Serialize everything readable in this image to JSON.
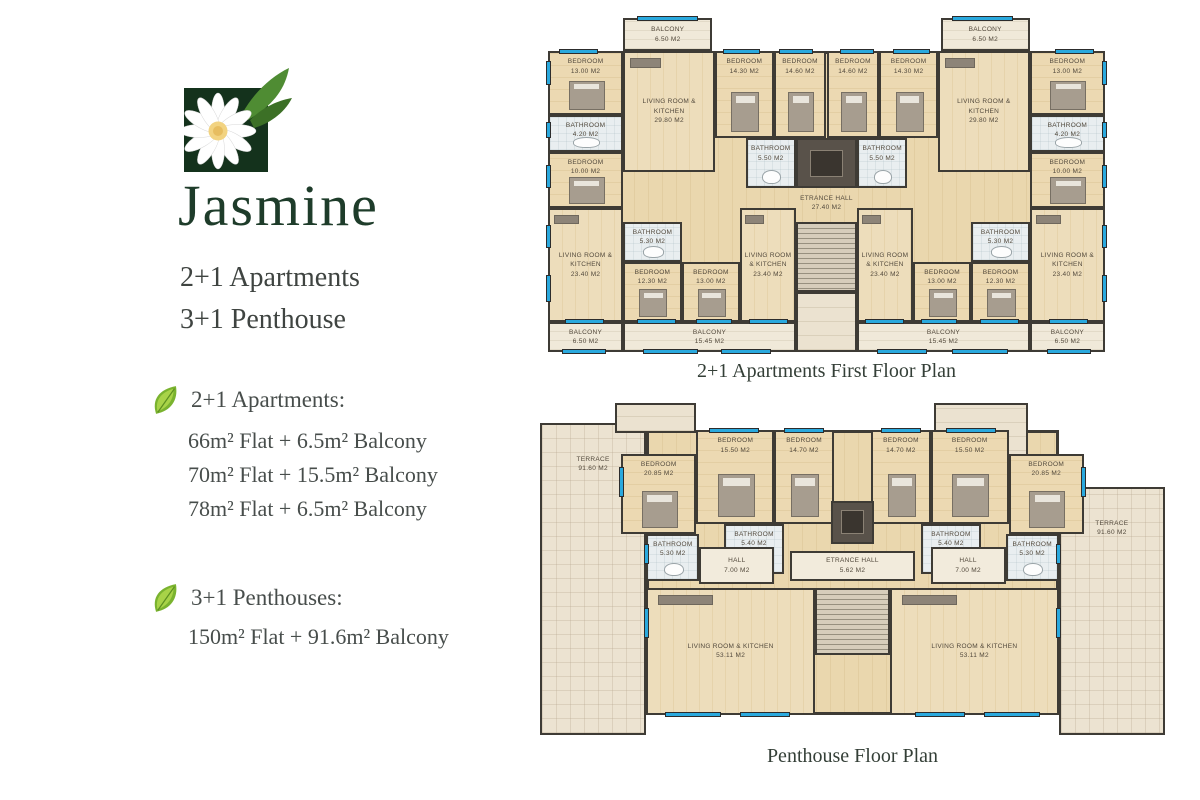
{
  "brand": {
    "name": "Jasmine",
    "subtitle_line1": "2+1 Apartments",
    "subtitle_line2": "3+1 Penthouse"
  },
  "specs": {
    "apartments": {
      "heading": "2+1 Apartments:",
      "items": [
        "66m² Flat + 6.5m² Balcony",
        "70m² Flat + 15.5m² Balcony",
        "78m² Flat + 6.5m² Balcony"
      ]
    },
    "penthouses": {
      "heading": "3+1 Penthouses:",
      "items": [
        "150m² Flat + 91.6m² Balcony"
      ]
    }
  },
  "colors": {
    "brand_green": "#1e3c2a",
    "logo_square_green": "#14321c",
    "leaf_green": "#7ab32f",
    "window_blue": "#2aa9de",
    "wood_floor": "#e9d5ab",
    "wall": "#3e3b35"
  },
  "plans": {
    "first_floor": {
      "caption": "2+1 Apartments First Floor Plan",
      "rooms": [
        {
          "type": "body",
          "x": 0,
          "y": 10,
          "w": 100,
          "h": 81
        },
        {
          "type": "balcony",
          "label": "BALCONY",
          "area": "6.50 M2",
          "x": 13.5,
          "y": 0,
          "w": 16,
          "h": 10
        },
        {
          "type": "balcony",
          "label": "BALCONY",
          "area": "6.50 M2",
          "x": 70.5,
          "y": 0,
          "w": 16,
          "h": 10
        },
        {
          "type": "bedroom",
          "label": "BEDROOM",
          "area": "13.00 M2",
          "x": 0,
          "y": 10,
          "w": 13.5,
          "h": 19
        },
        {
          "type": "bathroom",
          "label": "BATHROOM",
          "area": "4.20 M2",
          "x": 0,
          "y": 29,
          "w": 13.5,
          "h": 11
        },
        {
          "type": "bedroom",
          "label": "BEDROOM",
          "area": "10.00 M2",
          "x": 0,
          "y": 40,
          "w": 13.5,
          "h": 17
        },
        {
          "type": "living",
          "label": "LIVING ROOM & KITCHEN",
          "area": "29.80 M2",
          "x": 13.5,
          "y": 10,
          "w": 16.5,
          "h": 36
        },
        {
          "type": "bedroom",
          "label": "BEDROOM",
          "area": "14.30 M2",
          "x": 30,
          "y": 10,
          "w": 10.5,
          "h": 26
        },
        {
          "type": "bedroom",
          "label": "BEDROOM",
          "area": "14.60 M2",
          "x": 40.5,
          "y": 10,
          "w": 9.5,
          "h": 26
        },
        {
          "type": "bedroom",
          "label": "BEDROOM",
          "area": "14.60 M2",
          "x": 50,
          "y": 10,
          "w": 9.5,
          "h": 26
        },
        {
          "type": "bedroom",
          "label": "BEDROOM",
          "area": "14.30 M2",
          "x": 59.5,
          "y": 10,
          "w": 10.5,
          "h": 26
        },
        {
          "type": "living",
          "label": "LIVING ROOM & KITCHEN",
          "area": "29.80 M2",
          "x": 70,
          "y": 10,
          "w": 16.5,
          "h": 36
        },
        {
          "type": "bedroom",
          "label": "BEDROOM",
          "area": "13.00 M2",
          "x": 86.5,
          "y": 10,
          "w": 13.5,
          "h": 19
        },
        {
          "type": "bathroom",
          "label": "BATHROOM",
          "area": "4.20 M2",
          "x": 86.5,
          "y": 29,
          "w": 13.5,
          "h": 11
        },
        {
          "type": "bedroom",
          "label": "BEDROOM",
          "area": "10.00 M2",
          "x": 86.5,
          "y": 40,
          "w": 13.5,
          "h": 17
        },
        {
          "type": "bathroom",
          "label": "BATHROOM",
          "area": "5.50 M2",
          "x": 35.5,
          "y": 36,
          "w": 9,
          "h": 15
        },
        {
          "type": "elevator",
          "x": 44.5,
          "y": 36,
          "w": 11,
          "h": 15
        },
        {
          "type": "bathroom",
          "label": "BATHROOM",
          "area": "5.50 M2",
          "x": 55.5,
          "y": 36,
          "w": 9,
          "h": 15
        },
        {
          "type": "openhall",
          "label": "ETRANCE HALL",
          "area": "27.40 M2",
          "x": 30,
          "y": 51,
          "w": 40,
          "h": 9
        },
        {
          "type": "block",
          "x": 44.5,
          "y": 82,
          "w": 11,
          "h": 18
        },
        {
          "type": "stairs",
          "x": 44.5,
          "y": 61,
          "w": 11,
          "h": 21
        },
        {
          "type": "living",
          "label": "LIVING ROOM & KITCHEN",
          "area": "23.40 M2",
          "x": 0,
          "y": 57,
          "w": 13.5,
          "h": 34
        },
        {
          "type": "bathroom",
          "label": "BATHROOM",
          "area": "5.30 M2",
          "x": 13.5,
          "y": 61,
          "w": 10.5,
          "h": 12
        },
        {
          "type": "bedroom",
          "label": "BEDROOM",
          "area": "12.30 M2",
          "x": 13.5,
          "y": 73,
          "w": 10.5,
          "h": 18
        },
        {
          "type": "bedroom",
          "label": "BEDROOM",
          "area": "13.00 M2",
          "x": 24,
          "y": 73,
          "w": 10.5,
          "h": 18
        },
        {
          "type": "living",
          "label": "LIVING ROOM & KITCHEN",
          "area": "23.40 M2",
          "x": 34.5,
          "y": 57,
          "w": 10,
          "h": 34
        },
        {
          "type": "living",
          "label": "LIVING ROOM & KITCHEN",
          "area": "23.40 M2",
          "x": 55.5,
          "y": 57,
          "w": 10,
          "h": 34
        },
        {
          "type": "bedroom",
          "label": "BEDROOM",
          "area": "13.00 M2",
          "x": 65.5,
          "y": 73,
          "w": 10.5,
          "h": 18
        },
        {
          "type": "bedroom",
          "label": "BEDROOM",
          "area": "12.30 M2",
          "x": 76,
          "y": 73,
          "w": 10.5,
          "h": 18
        },
        {
          "type": "bathroom",
          "label": "BATHROOM",
          "area": "5.30 M2",
          "x": 76,
          "y": 61,
          "w": 10.5,
          "h": 12
        },
        {
          "type": "living",
          "label": "LIVING ROOM & KITCHEN",
          "area": "23.40 M2",
          "x": 86.5,
          "y": 57,
          "w": 13.5,
          "h": 34
        },
        {
          "type": "balcony",
          "label": "BALCONY",
          "area": "6.50 M2",
          "x": 0,
          "y": 91,
          "w": 13.5,
          "h": 9
        },
        {
          "type": "balcony",
          "label": "BALCONY",
          "area": "15.45 M2",
          "x": 13.5,
          "y": 91,
          "w": 31,
          "h": 9
        },
        {
          "type": "balcony",
          "label": "BALCONY",
          "area": "15.45 M2",
          "x": 55.5,
          "y": 91,
          "w": 31,
          "h": 9
        },
        {
          "type": "balcony",
          "label": "BALCONY",
          "area": "6.50 M2",
          "x": 86.5,
          "y": 91,
          "w": 13.5,
          "h": 9
        }
      ],
      "windows": [
        {
          "x": 16,
          "y": -0.6,
          "w": 11,
          "h": 1.5
        },
        {
          "x": 72.5,
          "y": -0.6,
          "w": 11,
          "h": 1.5
        },
        {
          "x": 2,
          "y": 9.3,
          "w": 7,
          "h": 1.5
        },
        {
          "x": 31.5,
          "y": 9.3,
          "w": 6.5,
          "h": 1.5
        },
        {
          "x": 41.5,
          "y": 9.3,
          "w": 6,
          "h": 1.5
        },
        {
          "x": 52.5,
          "y": 9.3,
          "w": 6,
          "h": 1.5
        },
        {
          "x": 62,
          "y": 9.3,
          "w": 6.5,
          "h": 1.5
        },
        {
          "x": 91,
          "y": 9.3,
          "w": 7,
          "h": 1.5
        },
        {
          "x": -0.4,
          "y": 13,
          "w": 0.9,
          "h": 7
        },
        {
          "x": -0.4,
          "y": 31,
          "w": 0.9,
          "h": 5
        },
        {
          "x": -0.4,
          "y": 44,
          "w": 0.9,
          "h": 7
        },
        {
          "x": -0.4,
          "y": 62,
          "w": 0.9,
          "h": 7
        },
        {
          "x": -0.4,
          "y": 77,
          "w": 0.9,
          "h": 8
        },
        {
          "x": 99.5,
          "y": 13,
          "w": 0.9,
          "h": 7
        },
        {
          "x": 99.5,
          "y": 31,
          "w": 0.9,
          "h": 5
        },
        {
          "x": 99.5,
          "y": 44,
          "w": 0.9,
          "h": 7
        },
        {
          "x": 99.5,
          "y": 62,
          "w": 0.9,
          "h": 7
        },
        {
          "x": 99.5,
          "y": 77,
          "w": 0.9,
          "h": 8
        },
        {
          "x": 3,
          "y": 90.1,
          "w": 7,
          "h": 1.5
        },
        {
          "x": 16,
          "y": 90.1,
          "w": 7,
          "h": 1.5
        },
        {
          "x": 26.5,
          "y": 90.1,
          "w": 6.5,
          "h": 1.5
        },
        {
          "x": 36,
          "y": 90.1,
          "w": 7,
          "h": 1.5
        },
        {
          "x": 57,
          "y": 90.1,
          "w": 7,
          "h": 1.5
        },
        {
          "x": 67,
          "y": 90.1,
          "w": 6.5,
          "h": 1.5
        },
        {
          "x": 77.5,
          "y": 90.1,
          "w": 7,
          "h": 1.5
        },
        {
          "x": 90,
          "y": 90.1,
          "w": 7,
          "h": 1.5
        },
        {
          "x": 2.5,
          "y": 99.1,
          "w": 8,
          "h": 1.5
        },
        {
          "x": 17,
          "y": 99.1,
          "w": 10,
          "h": 1.5
        },
        {
          "x": 31,
          "y": 99.1,
          "w": 9,
          "h": 1.5
        },
        {
          "x": 59,
          "y": 99.1,
          "w": 9,
          "h": 1.5
        },
        {
          "x": 72.5,
          "y": 99.1,
          "w": 10,
          "h": 1.5
        },
        {
          "x": 89.5,
          "y": 99.1,
          "w": 8,
          "h": 1.5
        }
      ]
    },
    "penthouse": {
      "caption": "Penthouse Floor Plan",
      "rooms": [
        {
          "type": "body",
          "x": 17,
          "y": 9,
          "w": 66,
          "h": 85
        },
        {
          "type": "terrace",
          "label": "TERRACE",
          "area": "91.60 M2",
          "x": 0,
          "y": 7,
          "w": 17,
          "h": 93
        },
        {
          "type": "terrace",
          "label": "TERRACE",
          "area": "91.60 M2",
          "x": 83,
          "y": 26,
          "w": 17,
          "h": 74
        },
        {
          "type": "block",
          "x": 12,
          "y": 1,
          "w": 13,
          "h": 9
        },
        {
          "type": "block",
          "x": 63,
          "y": 1,
          "w": 15,
          "h": 19
        },
        {
          "type": "bedroom",
          "label": "BEDROOM",
          "area": "20.85 M2",
          "x": 13,
          "y": 16,
          "w": 12,
          "h": 24
        },
        {
          "type": "bedroom",
          "label": "BEDROOM",
          "area": "15.50 M2",
          "x": 25,
          "y": 9,
          "w": 12.5,
          "h": 28
        },
        {
          "type": "bedroom",
          "label": "BEDROOM",
          "area": "14.70 M2",
          "x": 37.5,
          "y": 9,
          "w": 9.5,
          "h": 28
        },
        {
          "type": "bedroom",
          "label": "BEDROOM",
          "area": "14.70 M2",
          "x": 53,
          "y": 9,
          "w": 9.5,
          "h": 28
        },
        {
          "type": "bedroom",
          "label": "BEDROOM",
          "area": "15.50 M2",
          "x": 62.5,
          "y": 9,
          "w": 12.5,
          "h": 28
        },
        {
          "type": "bedroom",
          "label": "BEDROOM",
          "area": "20.85 M2",
          "x": 75,
          "y": 16,
          "w": 12,
          "h": 24
        },
        {
          "type": "elevator",
          "x": 46.5,
          "y": 30,
          "w": 7,
          "h": 13
        },
        {
          "type": "bathroom",
          "label": "BATHROOM",
          "area": "5.40 M2",
          "x": 29.5,
          "y": 37,
          "w": 9.5,
          "h": 15
        },
        {
          "type": "bathroom",
          "label": "BATHROOM",
          "area": "5.40 M2",
          "x": 61,
          "y": 37,
          "w": 9.5,
          "h": 15
        },
        {
          "type": "bathroom",
          "label": "BATHROOM",
          "area": "5.30 M2",
          "x": 17,
          "y": 40,
          "w": 8.5,
          "h": 14
        },
        {
          "type": "bathroom",
          "label": "BATHROOM",
          "area": "5.30 M2",
          "x": 74.5,
          "y": 40,
          "w": 8.5,
          "h": 14
        },
        {
          "type": "hall",
          "label": "HALL",
          "area": "7.00 M2",
          "x": 25.5,
          "y": 44,
          "w": 12,
          "h": 11
        },
        {
          "type": "hall",
          "label": "HALL",
          "area": "7.00 M2",
          "x": 62.5,
          "y": 44,
          "w": 12,
          "h": 11
        },
        {
          "type": "hall",
          "label": "ETRANCE HALL",
          "area": "5.62 M2",
          "x": 40,
          "y": 45,
          "w": 20,
          "h": 9
        },
        {
          "type": "stairs",
          "x": 44,
          "y": 56,
          "w": 12,
          "h": 20
        },
        {
          "type": "living",
          "label": "LIVING ROOM & KITCHEN",
          "area": "53.11 M2",
          "x": 17,
          "y": 56,
          "w": 27,
          "h": 38
        },
        {
          "type": "living",
          "label": "LIVING ROOM & KITCHEN",
          "area": "53.11 M2",
          "x": 56,
          "y": 56,
          "w": 27,
          "h": 38
        }
      ],
      "windows": [
        {
          "x": 27,
          "y": 8.3,
          "w": 8,
          "h": 1.5
        },
        {
          "x": 39,
          "y": 8.3,
          "w": 6.5,
          "h": 1.5
        },
        {
          "x": 54.5,
          "y": 8.3,
          "w": 6.5,
          "h": 1.5
        },
        {
          "x": 65,
          "y": 8.3,
          "w": 8,
          "h": 1.5
        },
        {
          "x": 12.6,
          "y": 20,
          "w": 0.9,
          "h": 9
        },
        {
          "x": 86.5,
          "y": 20,
          "w": 0.9,
          "h": 9
        },
        {
          "x": 16.6,
          "y": 62,
          "w": 0.9,
          "h": 9
        },
        {
          "x": 82.5,
          "y": 62,
          "w": 0.9,
          "h": 9
        },
        {
          "x": 16.6,
          "y": 43,
          "w": 0.9,
          "h": 6
        },
        {
          "x": 82.5,
          "y": 43,
          "w": 0.9,
          "h": 6
        },
        {
          "x": 20,
          "y": 93.2,
          "w": 9,
          "h": 1.5
        },
        {
          "x": 32,
          "y": 93.2,
          "w": 8,
          "h": 1.5
        },
        {
          "x": 60,
          "y": 93.2,
          "w": 8,
          "h": 1.5
        },
        {
          "x": 71,
          "y": 93.2,
          "w": 9,
          "h": 1.5
        }
      ]
    }
  }
}
